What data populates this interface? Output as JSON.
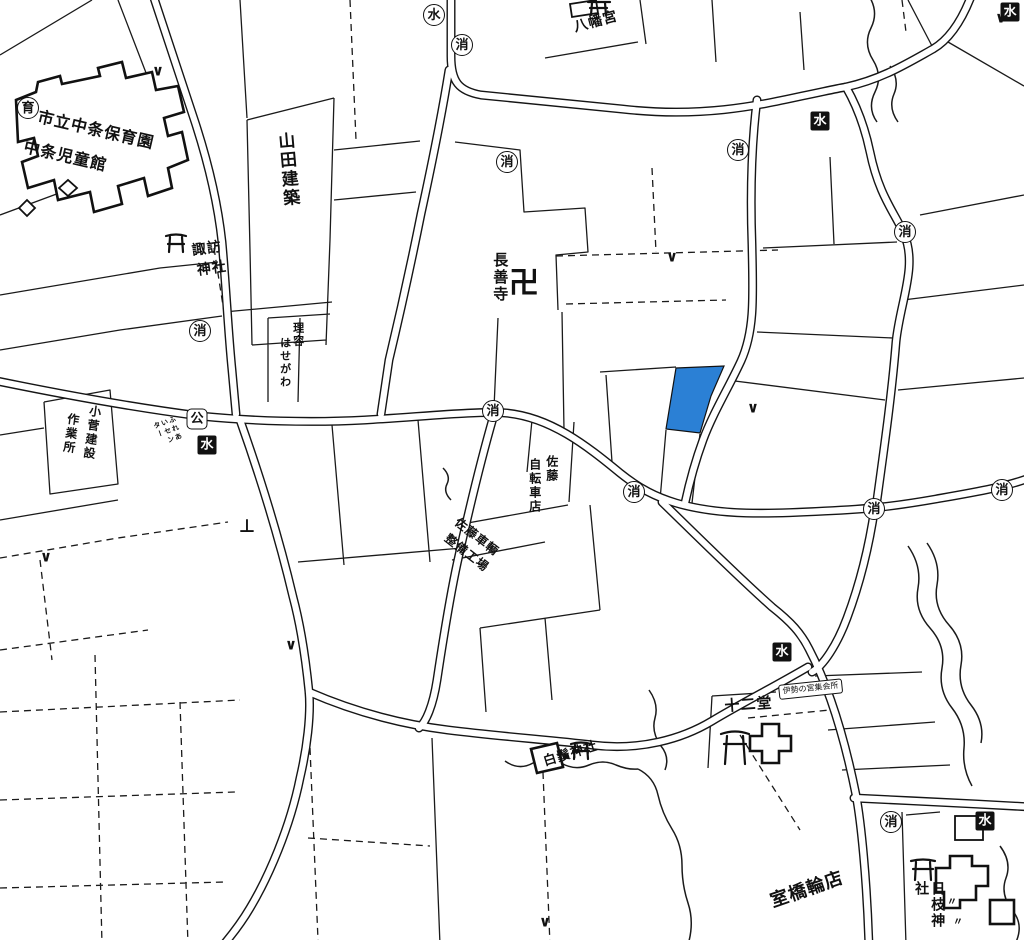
{
  "map": {
    "colors": {
      "background": "#ffffff",
      "line": "#1a1a1a",
      "highlight": "#2b80d5"
    },
    "selected_parcel": {
      "color": "#2b80d5"
    },
    "labels": [
      {
        "text": "市立中条保育園",
        "x": 40,
        "y": 108,
        "size": 16,
        "rot": 13
      },
      {
        "text": "中条児童館",
        "x": 26,
        "y": 138,
        "size": 16,
        "rot": 13
      },
      {
        "text": "山田建築",
        "x": 273,
        "y": 133,
        "size": 17,
        "rot": -5,
        "vertical": true
      },
      {
        "text": "諏訪",
        "x": 191,
        "y": 243,
        "size": 14,
        "rot": -8
      },
      {
        "text": "神社",
        "x": 196,
        "y": 263,
        "size": 14,
        "rot": -8
      },
      {
        "text": "理容",
        "x": 291,
        "y": 322,
        "size": 11,
        "vertical": true
      },
      {
        "text": "はせがわ",
        "x": 278,
        "y": 337,
        "size": 11,
        "vertical": true
      },
      {
        "text": "長善寺",
        "x": 491,
        "y": 252,
        "size": 15,
        "vertical": true
      },
      {
        "text": "八幡宮",
        "x": 572,
        "y": 20,
        "size": 14,
        "rot": -15
      },
      {
        "text": "小菅建設",
        "x": 88,
        "y": 404,
        "size": 12,
        "rot": 8,
        "vertical": true
      },
      {
        "text": "作業所",
        "x": 66,
        "y": 412,
        "size": 12,
        "rot": 8,
        "vertical": true
      },
      {
        "text": "ふれあいセンター",
        "x": 152,
        "y": 423,
        "size": 7,
        "rot": -20,
        "vertical": true,
        "colh": 32
      },
      {
        "text": "佐藤",
        "x": 544,
        "y": 455,
        "size": 12,
        "vertical": true
      },
      {
        "text": "自転車店",
        "x": 527,
        "y": 458,
        "size": 12,
        "vertical": true
      },
      {
        "text": "佐藤車輌",
        "x": 460,
        "y": 516,
        "size": 12,
        "rot": 38
      },
      {
        "text": "整備工場",
        "x": 450,
        "y": 532,
        "size": 12,
        "rot": 38
      },
      {
        "text": "十二堂",
        "x": 724,
        "y": 698,
        "size": 15,
        "rot": -4
      },
      {
        "text": "伊勢の宮集会所",
        "x": 778,
        "y": 685,
        "size": 8,
        "rot": -6,
        "boxed": true
      },
      {
        "text": "白鬚神社",
        "x": 542,
        "y": 756,
        "size": 13,
        "rot": -17
      },
      {
        "text": "室橋輪店",
        "x": 768,
        "y": 893,
        "size": 18,
        "rot": -19
      },
      {
        "text": "日枝神社",
        "x": 913,
        "y": 881,
        "size": 14,
        "vertical": true
      }
    ],
    "point_symbols": {
      "fire-hydrant": {
        "glyph": "消",
        "shape": "circle",
        "positions": [
          [
            462,
            45
          ],
          [
            507,
            162
          ],
          [
            738,
            150
          ],
          [
            905,
            232
          ],
          [
            200,
            331
          ],
          [
            493,
            411
          ],
          [
            634,
            492
          ],
          [
            874,
            509
          ],
          [
            1002,
            490
          ],
          [
            891,
            822
          ]
        ]
      },
      "fire-cistern": {
        "glyph": "水",
        "shape": "square-filled",
        "positions": [
          [
            207,
            445
          ],
          [
            820,
            121
          ],
          [
            782,
            652
          ],
          [
            985,
            821
          ],
          [
            1010,
            12
          ]
        ]
      },
      "water-facility": {
        "glyph": "水",
        "shape": "circle",
        "positions": [
          [
            434,
            15
          ]
        ]
      },
      "public-facility": {
        "glyph": "公",
        "shape": "rounded-square",
        "positions": [
          [
            197,
            419
          ]
        ]
      },
      "nursery-school": {
        "glyph": "育",
        "shape": "circle",
        "positions": [
          [
            28,
            108
          ]
        ]
      },
      "temple-manji": {
        "glyph": "卍",
        "shape": "plain",
        "size": 30,
        "positions": [
          [
            524,
            284
          ]
        ]
      },
      "field-mark": {
        "glyph": "∨",
        "shape": "plain",
        "size": 15,
        "positions": [
          [
            158,
            71
          ],
          [
            1001,
            18
          ],
          [
            672,
            257
          ],
          [
            753,
            408
          ],
          [
            46,
            557
          ],
          [
            291,
            645
          ],
          [
            545,
            922
          ]
        ]
      },
      "monument-mark": {
        "glyph": "⊥",
        "shape": "plain",
        "size": 18,
        "positions": [
          [
            247,
            527
          ]
        ]
      },
      "grass-mark": {
        "glyph": "〃",
        "shape": "plain",
        "size": 10,
        "positions": [
          [
            952,
            903
          ],
          [
            958,
            923
          ]
        ]
      }
    }
  }
}
